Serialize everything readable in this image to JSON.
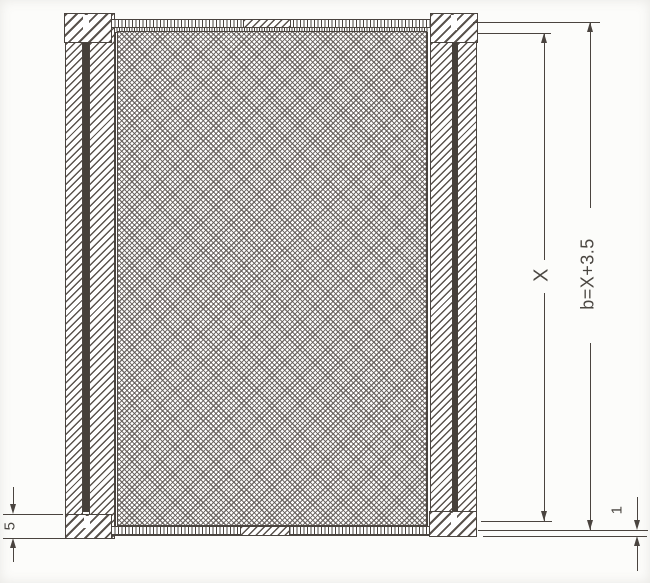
{
  "figure": {
    "kind": "technical-drawing",
    "description": "Front elevation of a rectangular screen frame with cross-hatched mesh panel, hatched frame members, spline bars, corner blocks and vertical dimension chains",
    "labels": {
      "dim_inner_height": "X",
      "dim_overall_height": "b=X+3.5",
      "dim_bottom_left": "5",
      "dim_bottom_right": "1"
    },
    "colors": {
      "ink": "#4a443f",
      "hatch": "#5a534d",
      "mesh_line": "#5f5854",
      "dark_bar": "#46403a",
      "background": "#fcfcfa"
    }
  }
}
